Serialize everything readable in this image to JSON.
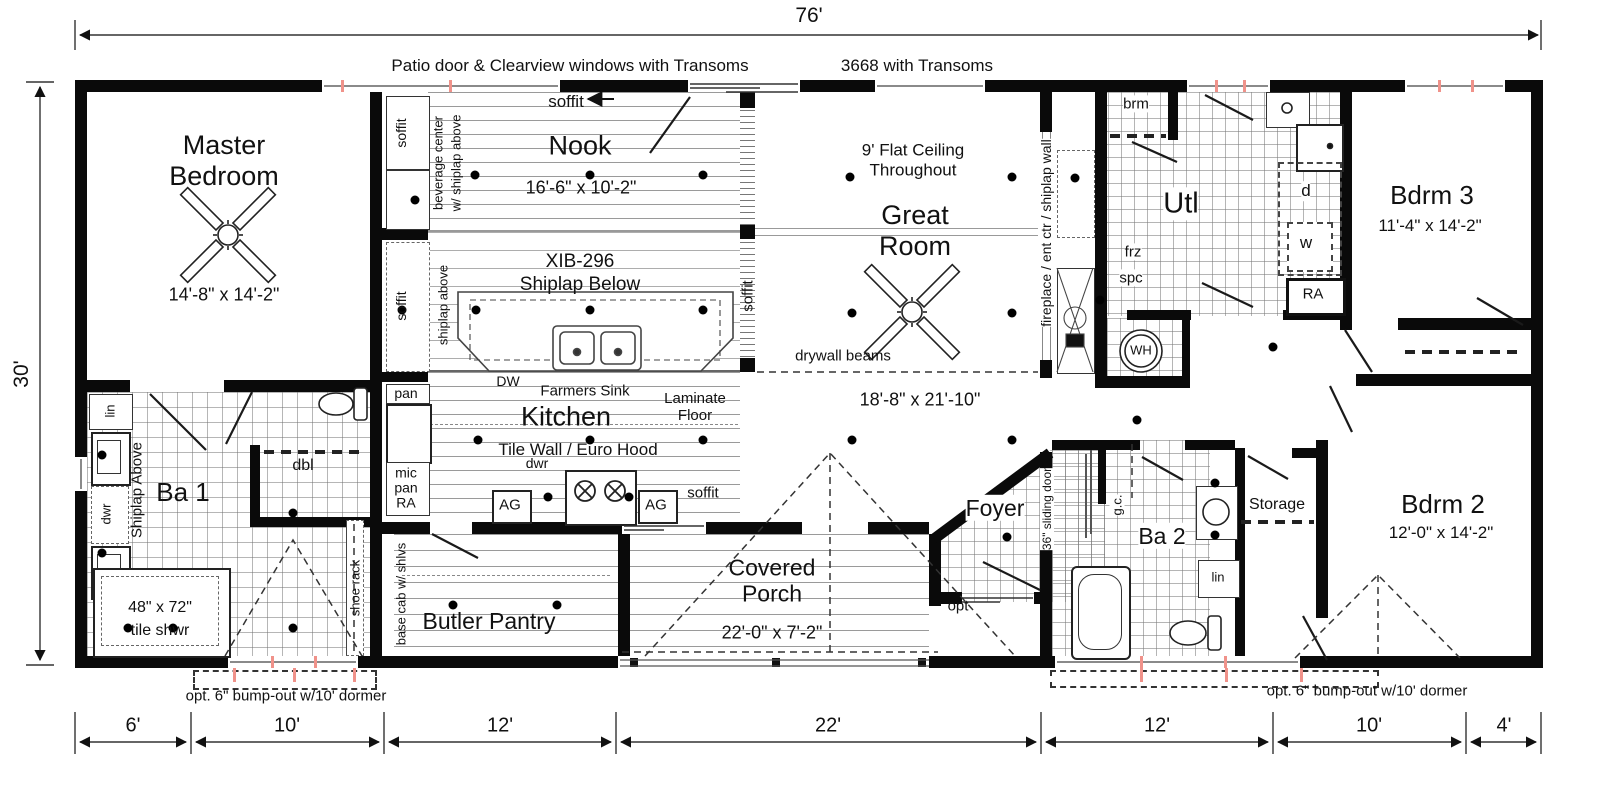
{
  "title_notes": {
    "patio": "Patio door & Clearview windows with Transoms",
    "door": "3668 with Transoms"
  },
  "dimensions": {
    "total_width": "76'",
    "total_depth": "30'",
    "bottom_segments": [
      "6'",
      "10'",
      "12'",
      "22'",
      "12'",
      "10'",
      "4'"
    ],
    "bump_out_left": "opt. 6\" bump-out w/10' dormer",
    "bump_out_right": "opt. 6\" bump-out w/10' dormer"
  },
  "rooms": {
    "master_bedroom": {
      "name": "Master Bedroom",
      "dims": "14'-8\" x 14'-2\""
    },
    "nook": {
      "name": "Nook",
      "dims": "16'-6\" x 10'-2\""
    },
    "great_room": {
      "name": "Great Room",
      "dims": "18'-8\" x 21'-10\"",
      "ceiling": "9' Flat Ceiling Throughout",
      "beams": "drywall beams",
      "feature_wall": "fireplace / ent ctr / shiplap wall"
    },
    "kitchen": {
      "name": "Kitchen",
      "sink": "Farmers Sink",
      "wall": "Tile Wall / Euro Hood",
      "floor": "Laminate Floor",
      "island_model": "XIB-296",
      "island_note": "Shiplap Below",
      "dw": "DW",
      "dwr": "dwr",
      "ag": "AG"
    },
    "butler_pantry": {
      "name": "Butler Pantry",
      "cab": "base cab w/ shlvs"
    },
    "covered_porch": {
      "name": "Covered Porch",
      "dims": "22'-0\" x 7'-2\""
    },
    "foyer": {
      "name": "Foyer",
      "door": "36\" sliding door",
      "opt": "opt"
    },
    "utility": {
      "name": "Utl",
      "broom": "brm",
      "frz": "frz",
      "spc": "spc",
      "dryer": "d",
      "washer": "w",
      "ra": "RA",
      "wh": "WH"
    },
    "bath1": {
      "name": "Ba 1",
      "shiplap": "Shiplap Above",
      "shower": "48\" x 72\"",
      "shower2": "tile shwr",
      "dwr": "dwr",
      "dbl": "dbl",
      "lin": "lin",
      "shoe": "shoe rack"
    },
    "bath2": {
      "name": "Ba 2",
      "gc": "g.c.",
      "lin": "lin"
    },
    "bedroom2": {
      "name": "Bdrm 2",
      "dims": "12'-0\" x 14'-2\""
    },
    "bedroom3": {
      "name": "Bdrm 3",
      "dims": "11'-4\" x 14'-2\""
    },
    "storage": {
      "name": "Storage"
    }
  },
  "labels": {
    "soffit": "soffit",
    "beverage1": "beverage center",
    "beverage2": "w/ shiplap above",
    "shiplap_above": "shiplap above",
    "pan": "pan",
    "mic": "mic",
    "ra": "RA"
  }
}
